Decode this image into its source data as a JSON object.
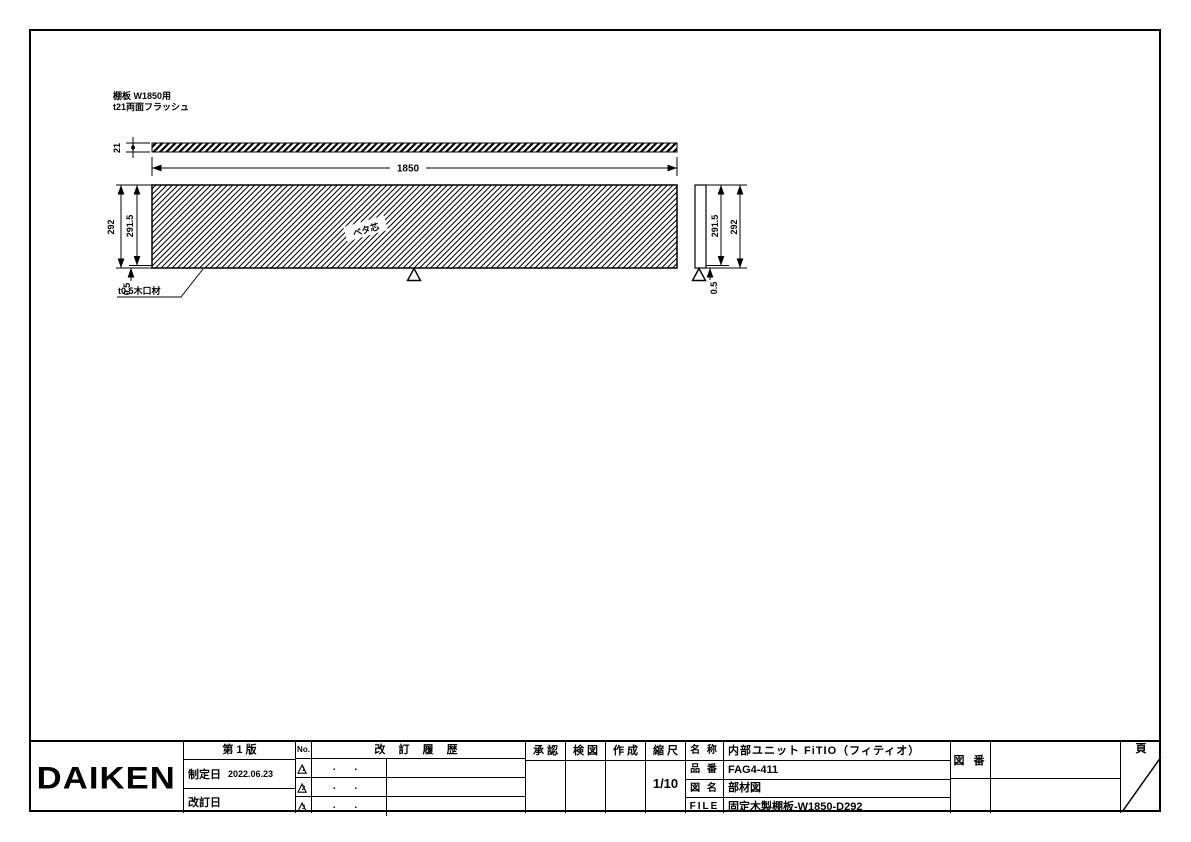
{
  "drawing": {
    "notes": {
      "line1": "棚板 W1850用",
      "line2": "t21両面フラッシュ"
    },
    "core_label": "ベタ芯",
    "edge_note": "t0.5木口材",
    "dims": {
      "thickness": "21",
      "length": "1850",
      "left_outer": "292",
      "left_inner": "291.5",
      "left_edge": "0.5",
      "right_inner": "291.5",
      "right_outer": "292",
      "right_edge": "0.5"
    }
  },
  "title_block": {
    "logo": "DAIKEN",
    "edition": "第 1 版",
    "enacted_label": "制定日",
    "enacted_date": "2022.06.23",
    "revised_label": "改訂日",
    "no_header": "No.",
    "history_header": "改 訂 履 歴",
    "approve_header": "承 認",
    "check_header": "検 図",
    "create_header": "作 成",
    "scale_header": "縮 尺",
    "scale_value": "1/10",
    "name_label": "名 称",
    "name_value": "内部ユニット FiTIO（フィティオ）",
    "part_label": "品 番",
    "part_value": "FAG4-411",
    "dwgname_label": "図 名",
    "dwgname_value": "部材図",
    "file_label": "FILE",
    "file_value": "固定木製棚板-W1850-D292",
    "dwgno_label": "図 番",
    "page_label": "頁",
    "revisions": [
      {
        "mark": "1",
        "date": ".  ."
      },
      {
        "mark": "2",
        "date": ".  ."
      },
      {
        "mark": "3",
        "date": ".  ."
      }
    ]
  },
  "colors": {
    "ink": "#000000",
    "paper": "#ffffff"
  }
}
